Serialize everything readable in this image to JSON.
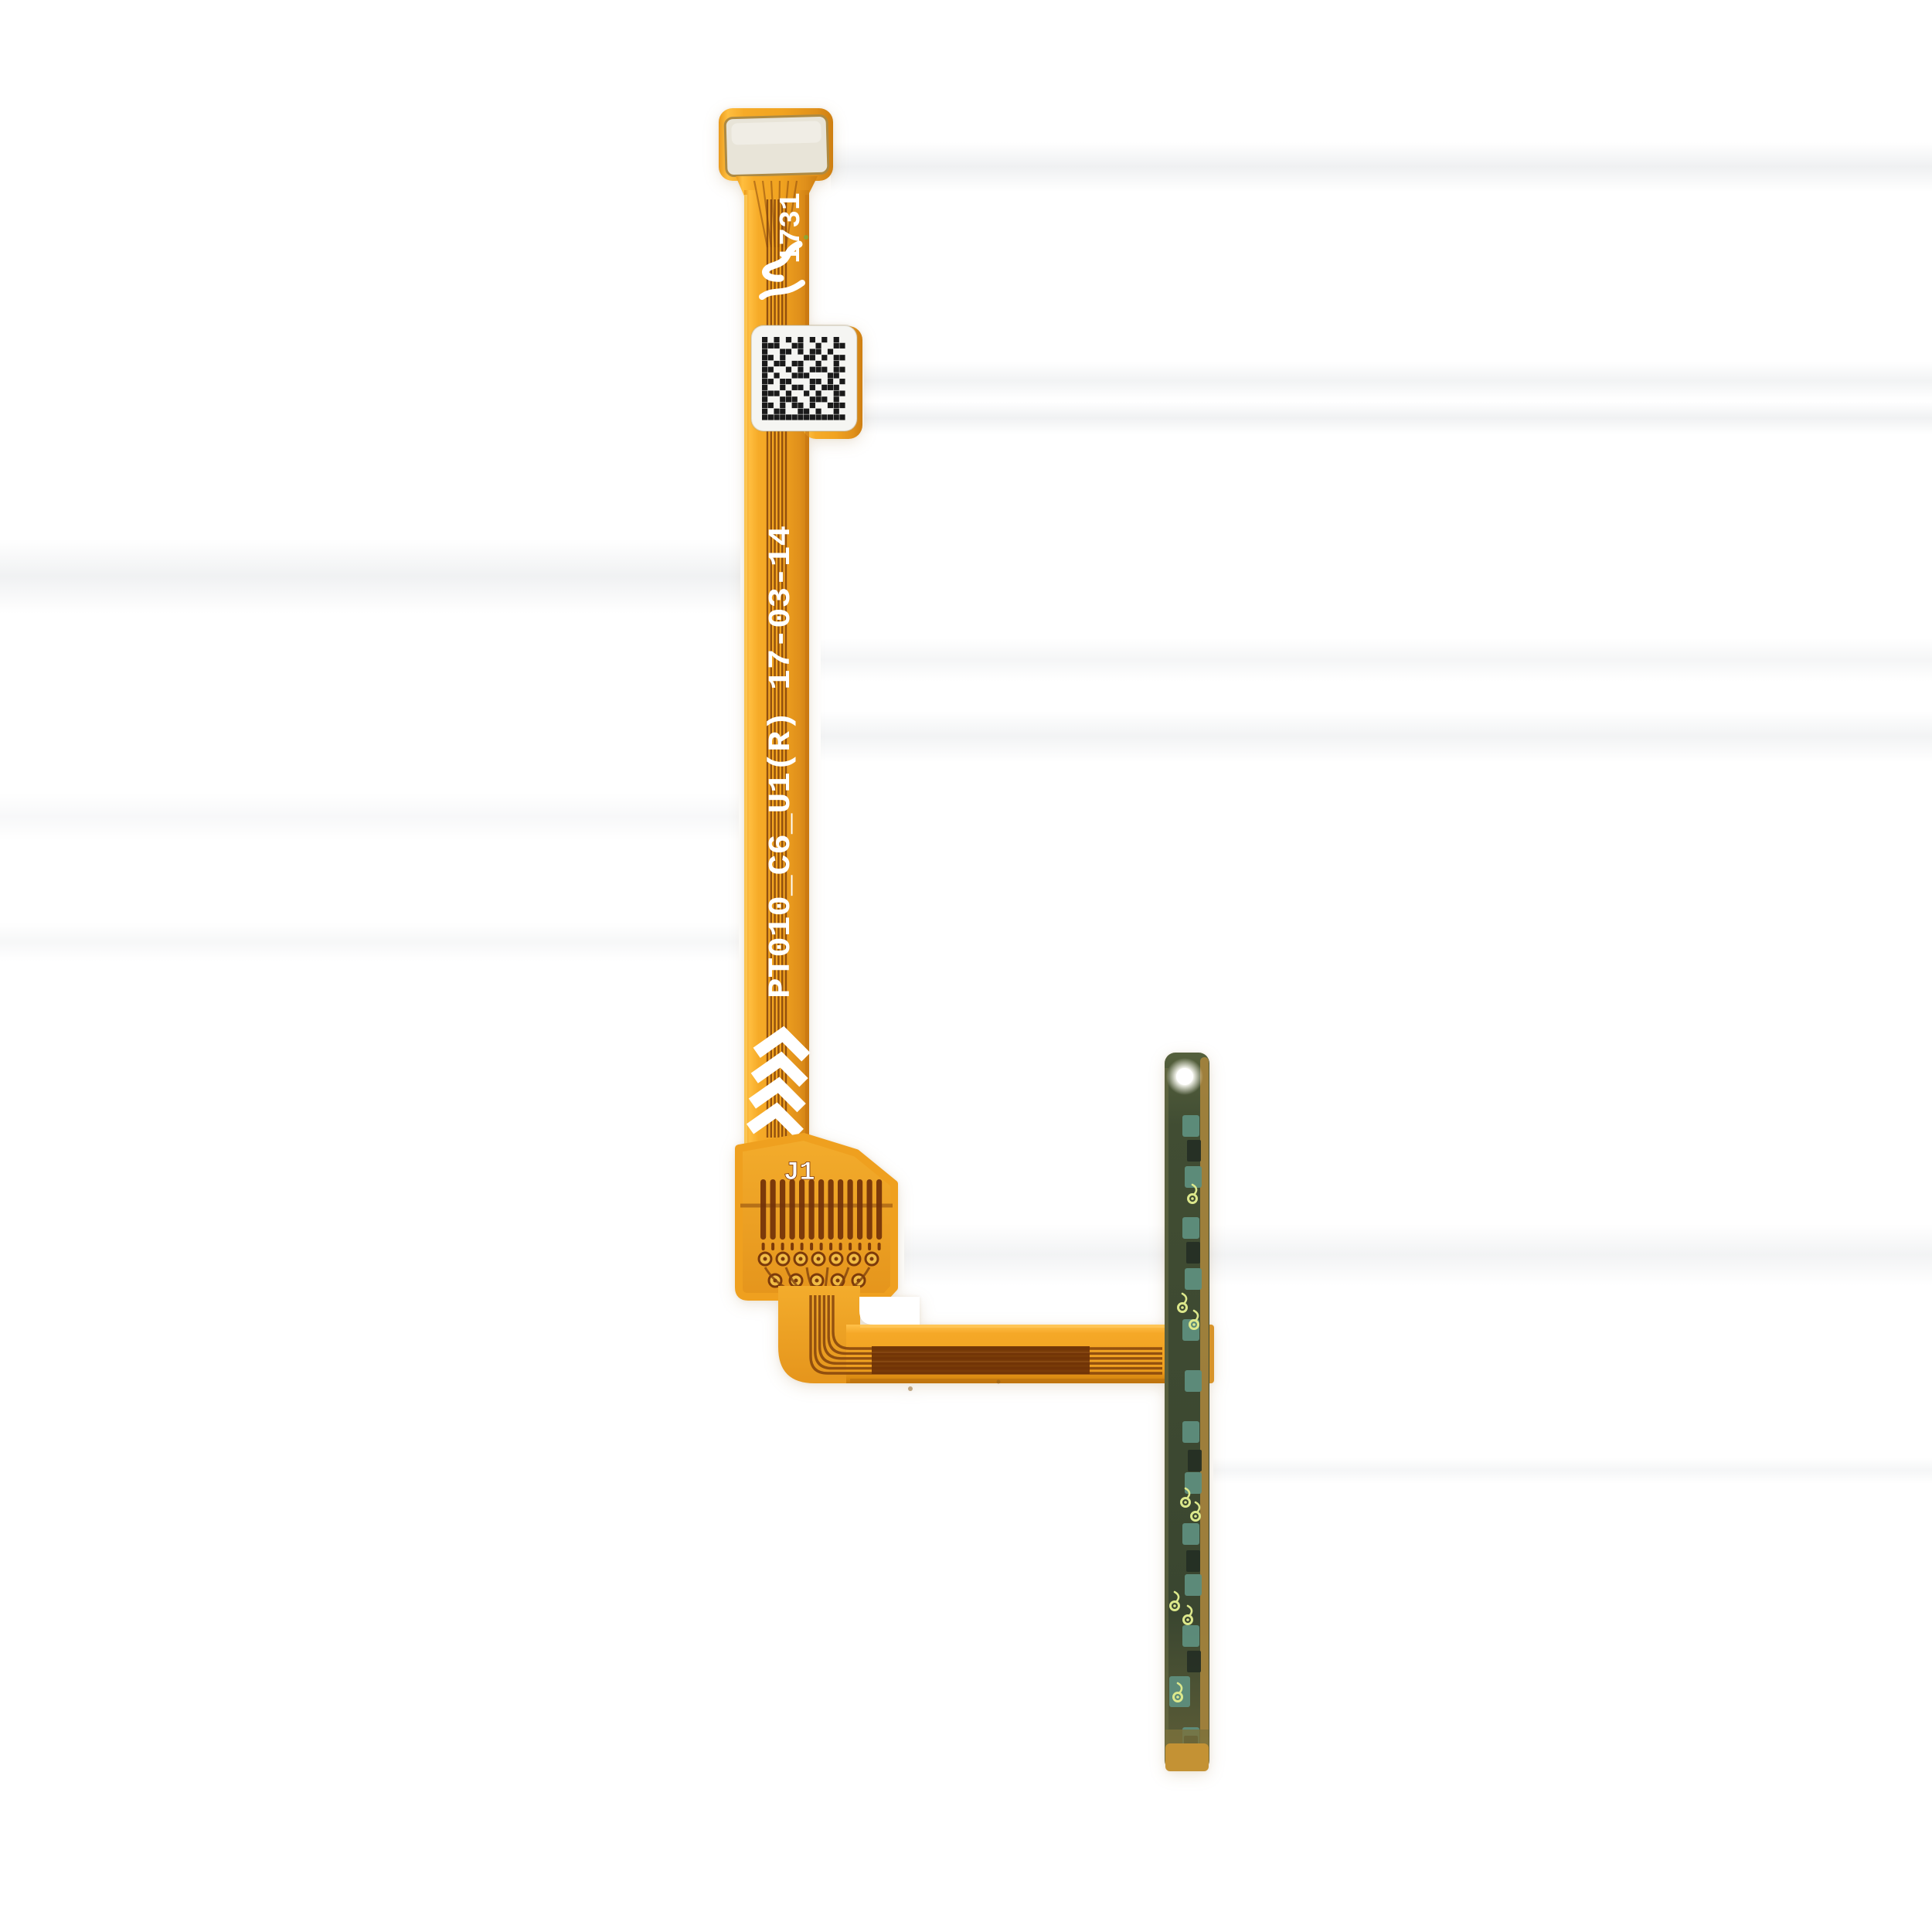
{
  "meta": {
    "type": "product-photo",
    "subject": "flex ribbon cable with QR code and side-button PCB strip on white background"
  },
  "labels": {
    "batch_code": "1731",
    "part_number": "PT010_C6_U1(R) 17-03-14",
    "connector_label": "J1"
  },
  "colors": {
    "background": "#FFFFFF",
    "flex_orange": "#F1A320",
    "flex_highlight": "#FFC94F",
    "flex_shadow": "#C87712",
    "trace_brown": "#82420C",
    "connector_dark": "#7C3A0A",
    "band_dark": "#6E3207",
    "stiffener_cream": "#E8E4D8",
    "stiffener_gold": "#AD8A43",
    "qr_black": "#1A1A1A",
    "qr_white": "#F5F5F2",
    "print_white": "#FFFFFF",
    "pcb_olive": "#414D33",
    "pcb_teal": "#5E8E7D",
    "pcb_dark_block": "#232E24",
    "pcb_gold_edge": "#A2823C",
    "eyelet_yellow": "#DCE88B",
    "led_white": "#FFFFFF",
    "strip_bottom_amber": "#C49234"
  },
  "qr": {
    "rows": 14,
    "cols": 14,
    "matrix": [
      "10101010101010",
      "11100110010011",
      "10011010110100",
      "11010001101011",
      "10110110010010",
      "11001010111011",
      "10100111000110",
      "11011000110101",
      "10010110101110",
      "11101001010011",
      "10011100111010",
      "11010110100111",
      "10110011010010",
      "11111111111111"
    ]
  },
  "connector": {
    "finger_count": 13,
    "pad_row1_count": 7,
    "pad_row2_count": 5
  },
  "marks": {
    "chevron_count": 4,
    "trace_line_count": 6
  },
  "button_strip": {
    "teal_pad_count": 13,
    "dark_block_count": 6,
    "eyelet_count": 8,
    "has_led_dot": true
  }
}
